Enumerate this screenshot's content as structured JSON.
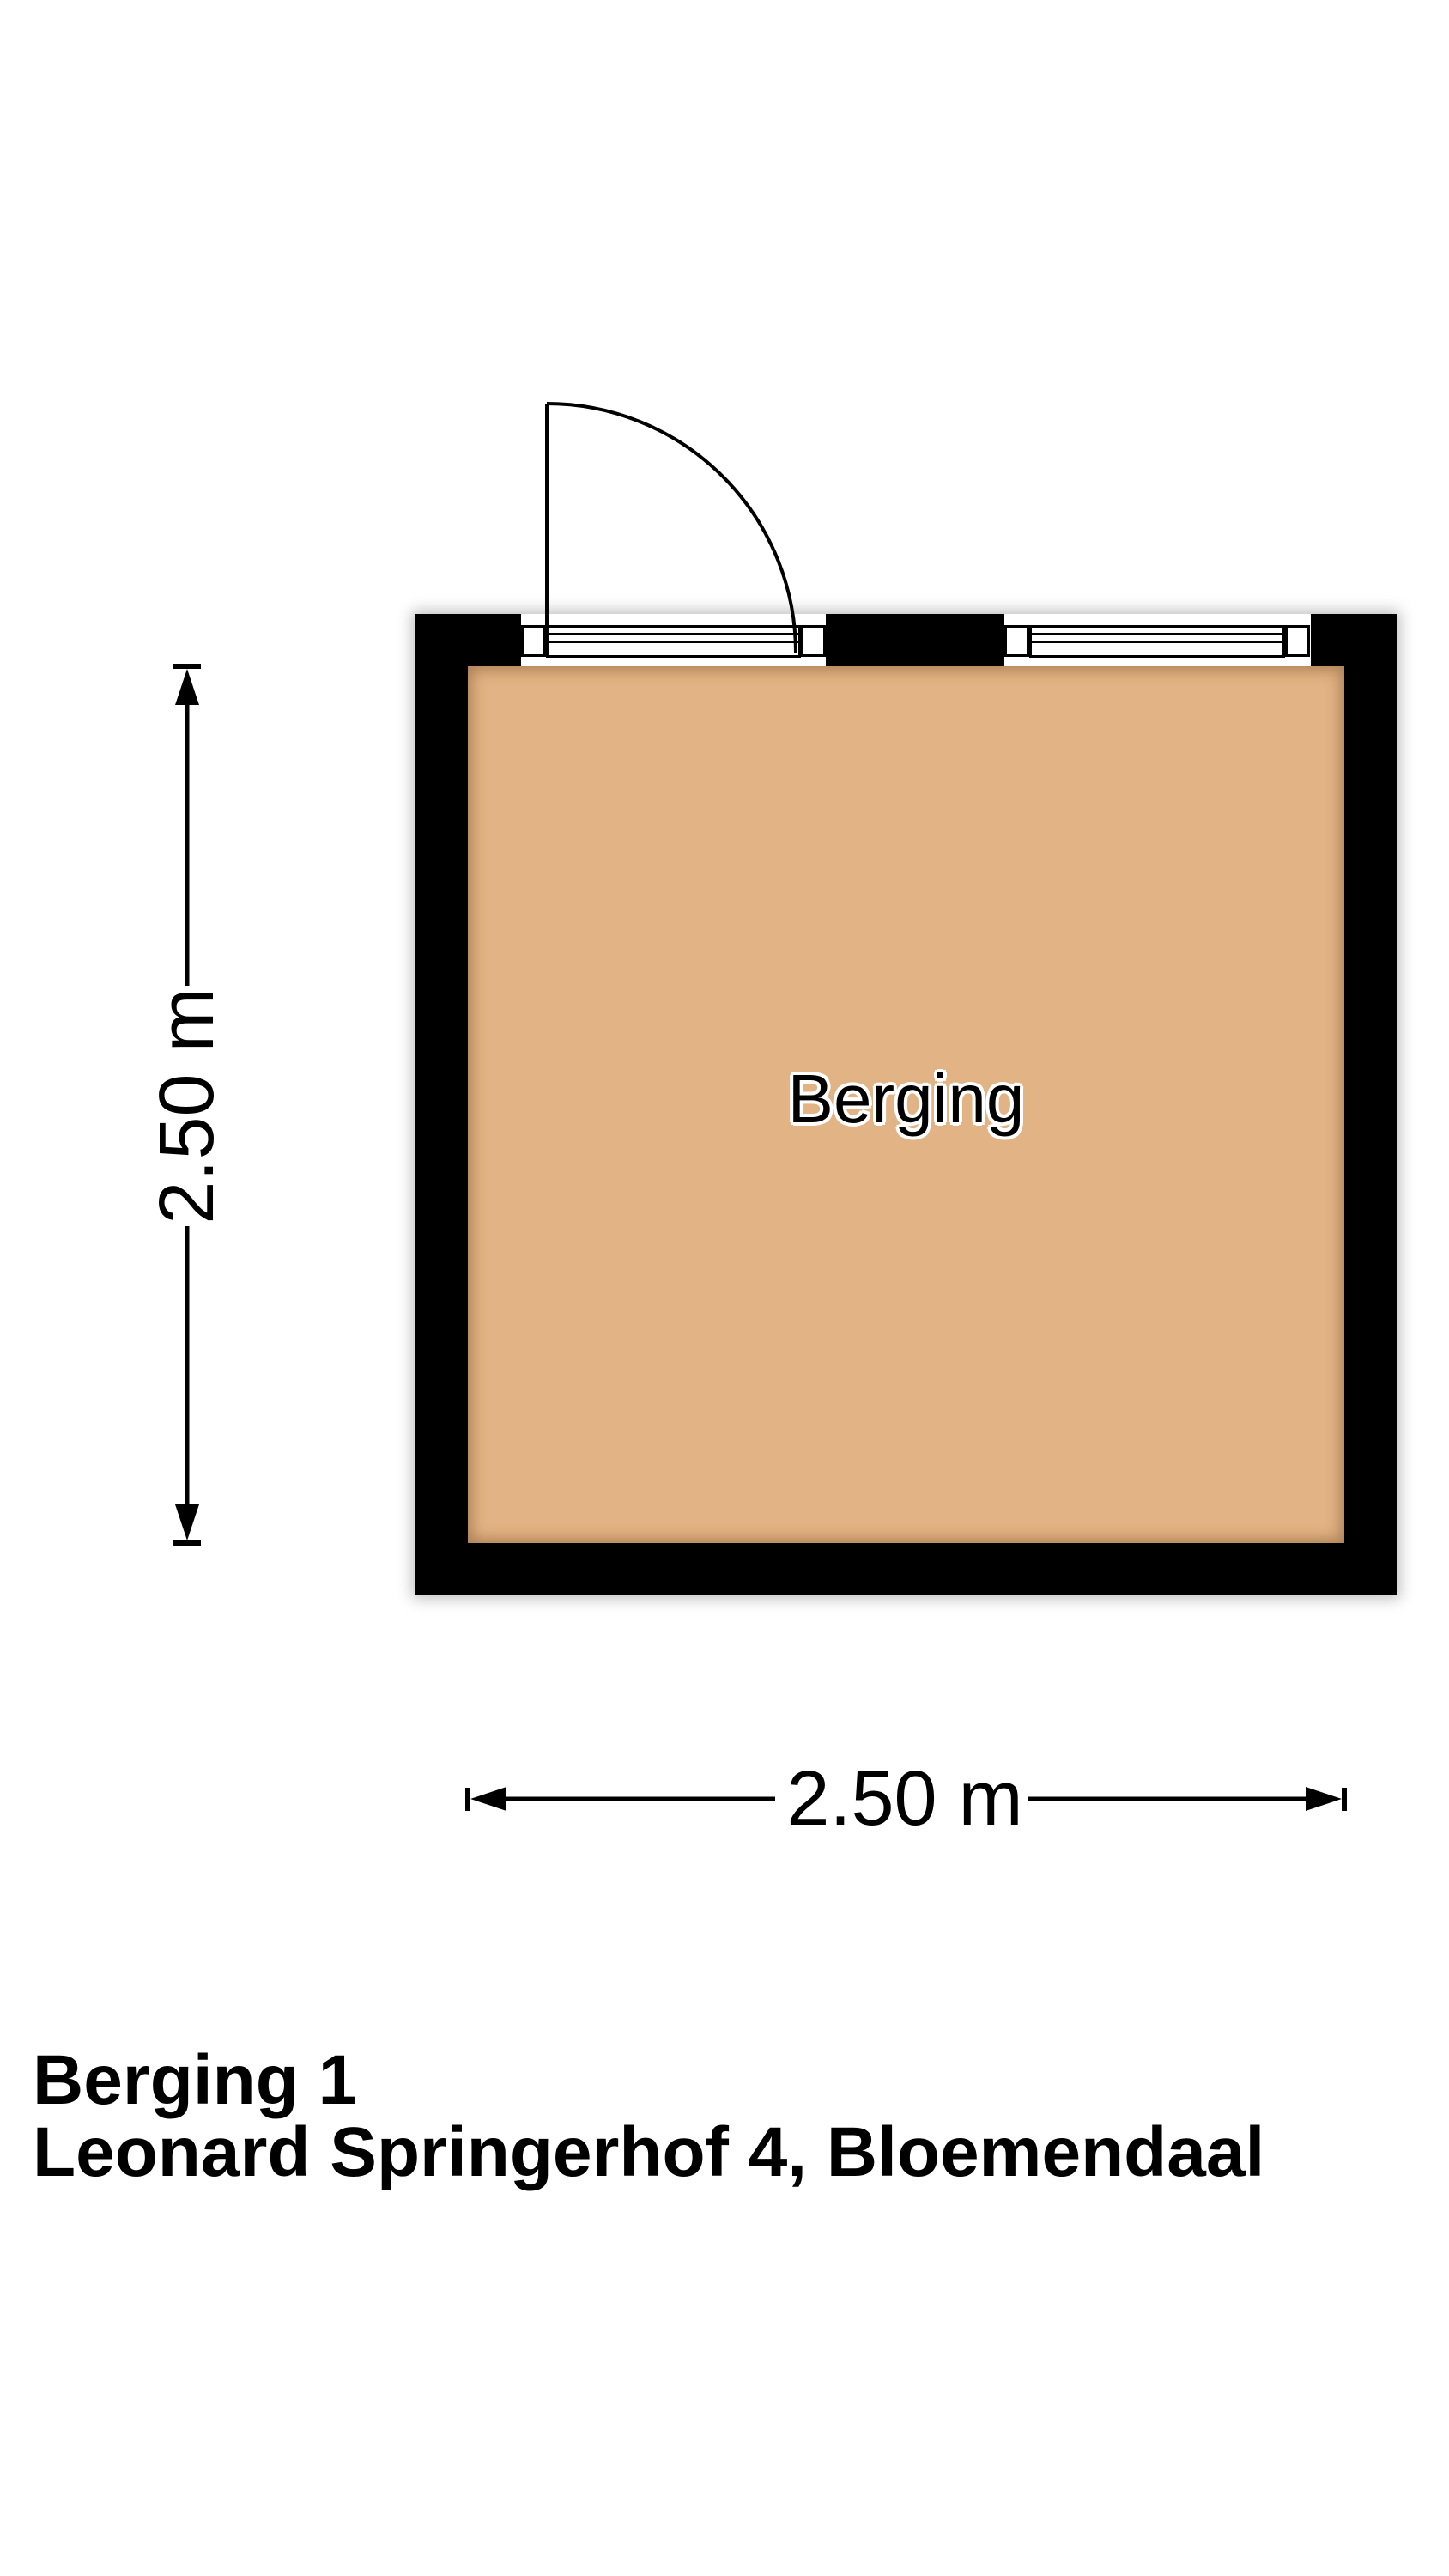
{
  "plan": {
    "room_label": "Berging",
    "wall_color": "#000000",
    "floor_color": "#e2b384",
    "background_color": "#ffffff"
  },
  "dimensions": {
    "vertical_label": "2.50 m",
    "horizontal_label": "2.50 m"
  },
  "footer": {
    "title": "Berging 1",
    "subtitle": "Leonard Springerhof 4, Bloemendaal"
  }
}
